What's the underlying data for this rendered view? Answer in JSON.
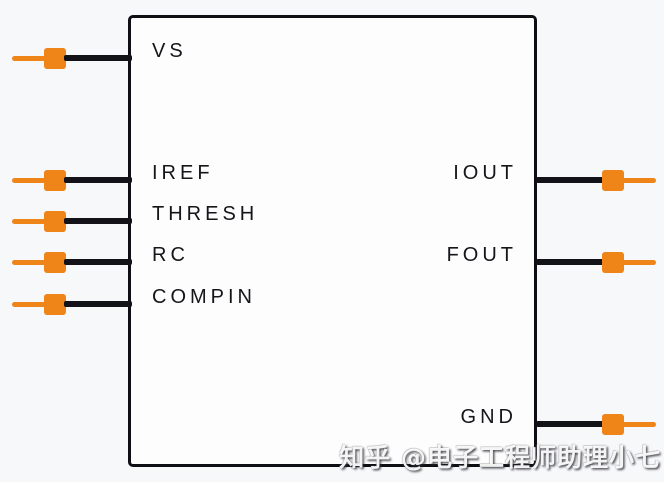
{
  "diagram": {
    "type": "ic-pin-diagram",
    "watermark": "知乎 @电子工程师助理小七",
    "colors": {
      "background": "#f7f8fa",
      "chip_fill": "#fdfdfe",
      "chip_border_black": "#0e0e14",
      "wire_black": "#121218",
      "pin_connector_orange": "#ef8418",
      "label_text": "#15151a"
    },
    "chip": {
      "left_pins": [
        {
          "label": "VS"
        },
        {
          "label": "IREF"
        },
        {
          "label": "THRESH"
        },
        {
          "label": "RC"
        },
        {
          "label": "COMPIN"
        }
      ],
      "right_pins": [
        {
          "label": "IOUT"
        },
        {
          "label": "FOUT"
        },
        {
          "label": "GND"
        }
      ]
    }
  }
}
